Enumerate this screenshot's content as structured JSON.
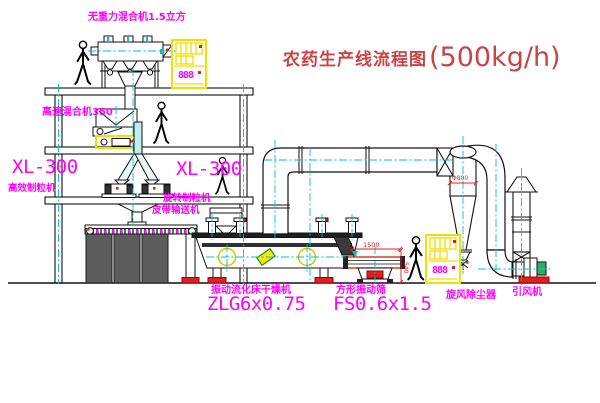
{
  "title": {
    "text": "农药生产线流程图",
    "capacity": "(500kg/h)"
  },
  "labels": {
    "gravity_mixer": "无重力混合机1.5立方",
    "high_speed_mixer": "高速混合机350",
    "granulator_left_model": "XL-300",
    "granulator_left_name": "高效制粒机",
    "granulator_right_model": "XL-300",
    "granulator_right_name": "旋转制粒机",
    "belt_conveyor": "皮带输送机",
    "dryer_name": "振动流化床干燥机",
    "dryer_model": "ZLG6x0.75",
    "sieve_name": "方形振动筛",
    "sieve_model": "FS0.6x1.5",
    "cyclone": "旋风除尘器",
    "fan": "引风机"
  },
  "dimensions": {
    "cyclone_dia": "Φ800",
    "sieve_width": "1500",
    "sieve_height": "540"
  },
  "cabinets": [
    {
      "display": "888"
    },
    {
      "display": "888"
    }
  ],
  "colors": {
    "label_magenta": "#ff00ff",
    "title_red": "#c94444",
    "dimension_red": "#dd2222",
    "centerline_cyan": "#00c3c3",
    "cabinet_yellow": "#f0df00",
    "line_black": "#111111"
  }
}
